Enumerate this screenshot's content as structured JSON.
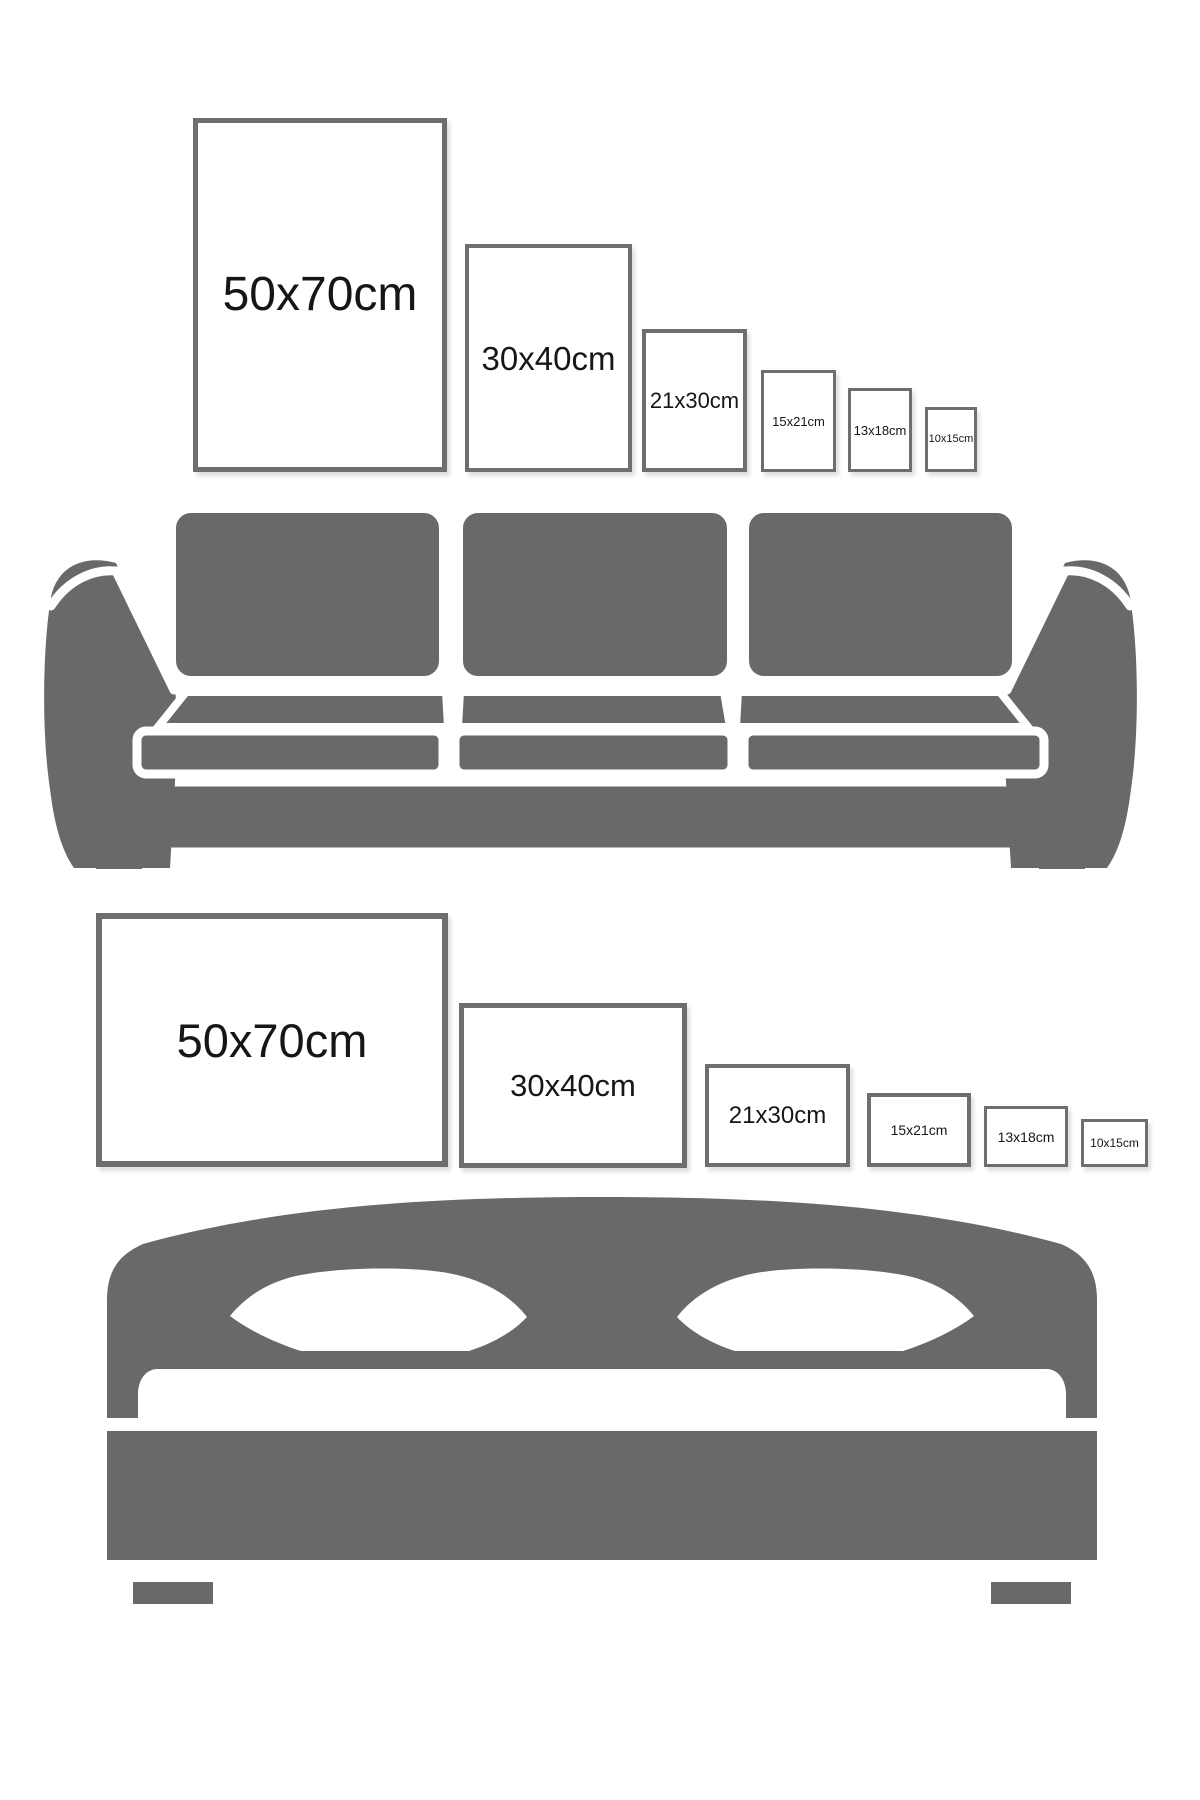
{
  "page": {
    "title": "Poster size comparison guide",
    "colors": {
      "furniture_gray": "#696969",
      "frame_border": "#6e6e6e",
      "label_text": "#161616",
      "background": "#ffffff"
    }
  },
  "portrait_set": {
    "name": "Portrait frames above sofa",
    "frames": [
      {
        "label": "50x70cm"
      },
      {
        "label": "30x40cm"
      },
      {
        "label": "21x30cm"
      },
      {
        "label": "15x21cm"
      },
      {
        "label": "13x18cm"
      },
      {
        "label": "10x15cm"
      }
    ],
    "illustration": "sofa"
  },
  "landscape_set": {
    "name": "Landscape frames above bed",
    "frames": [
      {
        "label": "50x70cm"
      },
      {
        "label": "30x40cm"
      },
      {
        "label": "21x30cm"
      },
      {
        "label": "15x21cm"
      },
      {
        "label": "13x18cm"
      },
      {
        "label": "10x15cm"
      }
    ],
    "illustration": "bed"
  }
}
